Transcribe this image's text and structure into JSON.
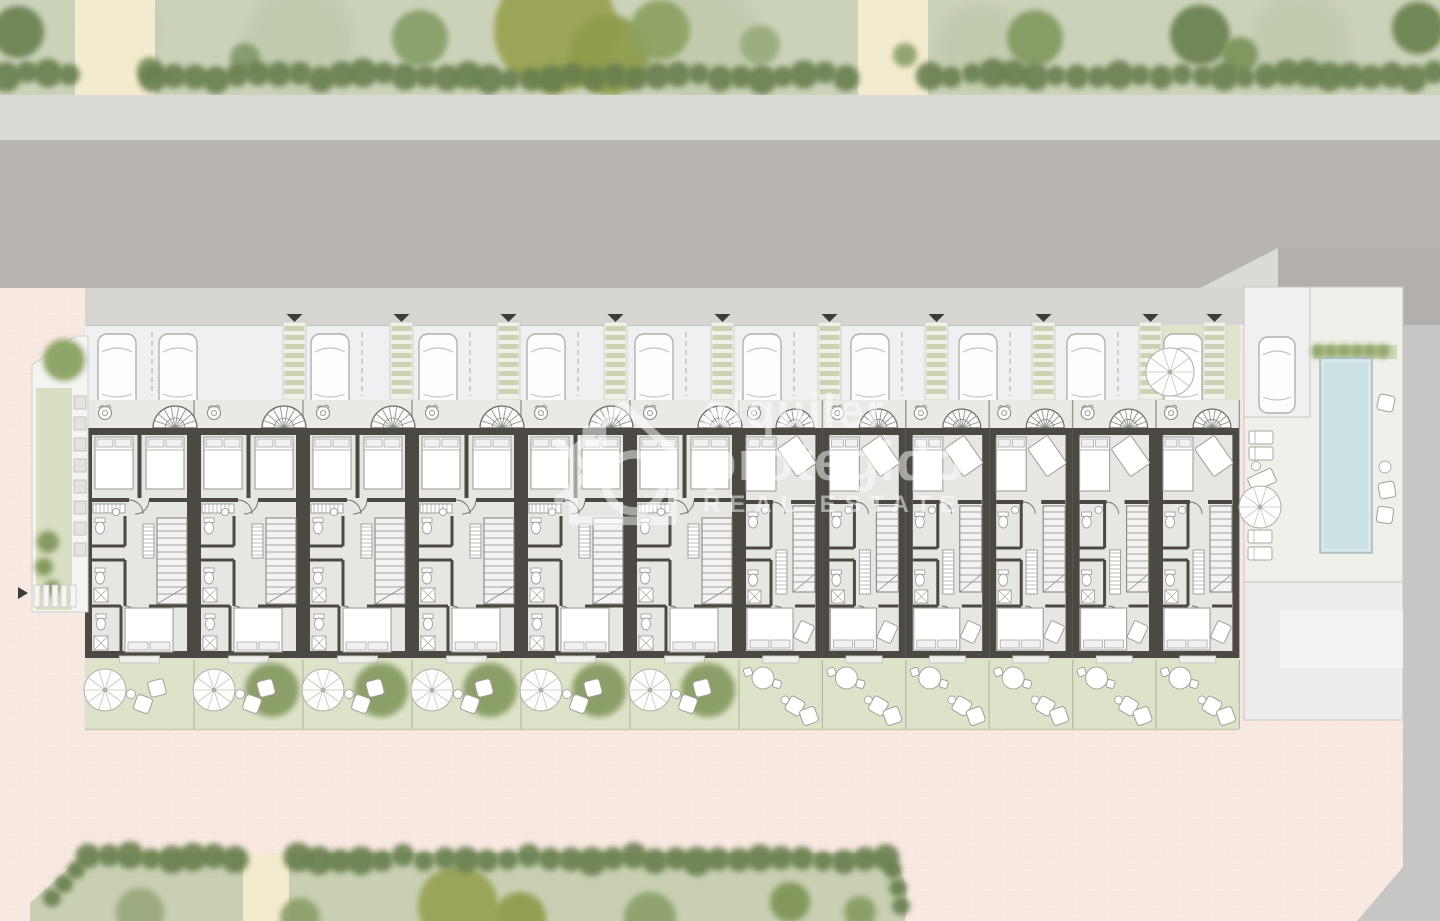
{
  "watermark": {
    "line1": "alquiler",
    "line2": "protegido",
    "line3": "REAL ESTATE",
    "color": "#ffffff"
  },
  "plan": {
    "kind": "residential-site-plan-ground-floor",
    "townhouse_units": {
      "left_block": 6,
      "right_block": 6,
      "total": 12
    },
    "parking": {
      "pergola_walkways": 10,
      "street_cars": 11,
      "pool_side_cars": 1,
      "entry_markers": 10
    },
    "amenities": [
      "swimming-pool",
      "pool-deck",
      "sun-loungers",
      "parasols",
      "private-gardens",
      "carports",
      "garden-furniture"
    ],
    "context": [
      "street",
      "sidewalk",
      "hedgerows",
      "trees",
      "paved-plaza",
      "footpaths",
      "crosswalk"
    ]
  },
  "colors": {
    "pink": "#f9e9e3",
    "pinkLine": "#efd7cf",
    "lawnTop": "#cbd2ba",
    "lawnBottom": "#c8cfb2",
    "hedge": "#687f4e",
    "pathBeige": "#f3ebcf",
    "sidewalkTop": "#dbdad7",
    "road": "#b7b4b1",
    "roadDark": "#b2afac",
    "sidewalkBottom": "#d6d5d2",
    "carportBg": "#eef0f2",
    "pergolaBg": "#eff1e9",
    "pergolaStripe": "#cbd3b2",
    "entranceBg": "#e9eae5",
    "wall": "#4c4843",
    "floor": "#e6e7e3",
    "furn": "#a19f9a",
    "furnFill": "#ffffff",
    "garden": "#dde3c8",
    "gardenLine": "#b5bca2",
    "deck": "#f1efe9",
    "deckLine": "#c9c6c0",
    "pool": "#cde2e5",
    "poolEdge": "#a9b8ba",
    "grayCol": "#c7c6c4",
    "lowerDeck": "#ececea",
    "lowerDeckInner": "#f3f3f1",
    "marker": "#3e3c39"
  }
}
